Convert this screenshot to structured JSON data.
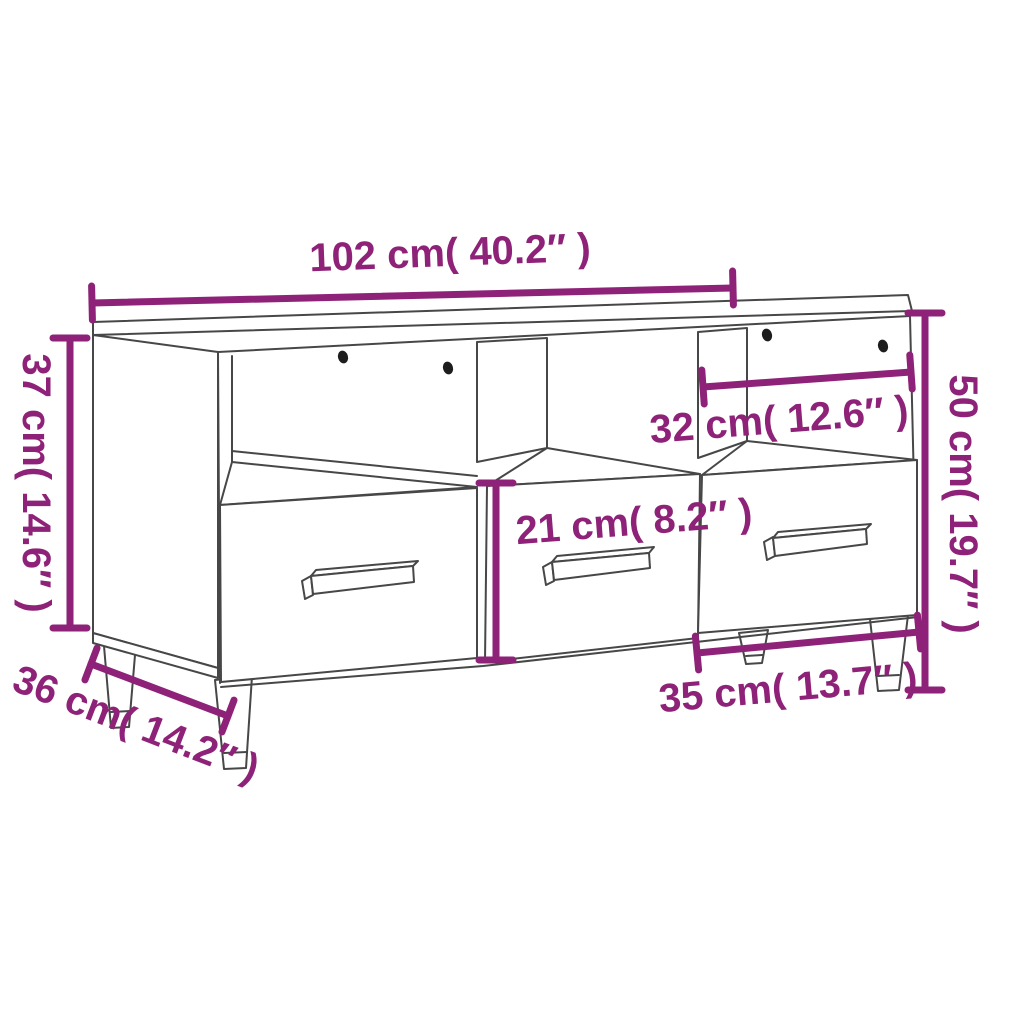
{
  "colors": {
    "dimension": "#8e2278",
    "line_art": "#474747",
    "screw": "#1d1d1d",
    "background": "#ffffff"
  },
  "dimensions": {
    "overall_width": {
      "label": "102 cm( 40.2″ )",
      "cm": 102,
      "inches": 40.2
    },
    "upper_section_height": {
      "label": "37 cm( 14.6″ )",
      "cm": 37,
      "inches": 14.6
    },
    "overall_height": {
      "label": "50 cm( 19.7″ )",
      "cm": 50,
      "inches": 19.7
    },
    "compartment_width": {
      "label": "32 cm( 12.6″ )",
      "cm": 32,
      "inches": 12.6
    },
    "drawer_height": {
      "label": "21 cm( 8.2″ )",
      "cm": 21,
      "inches": 8.2
    },
    "drawer_width": {
      "label": "35 cm( 13.7″ )",
      "cm": 35,
      "inches": 13.7
    },
    "depth": {
      "label": "36 cm( 14.2″ )",
      "cm": 36,
      "inches": 14.2
    }
  }
}
